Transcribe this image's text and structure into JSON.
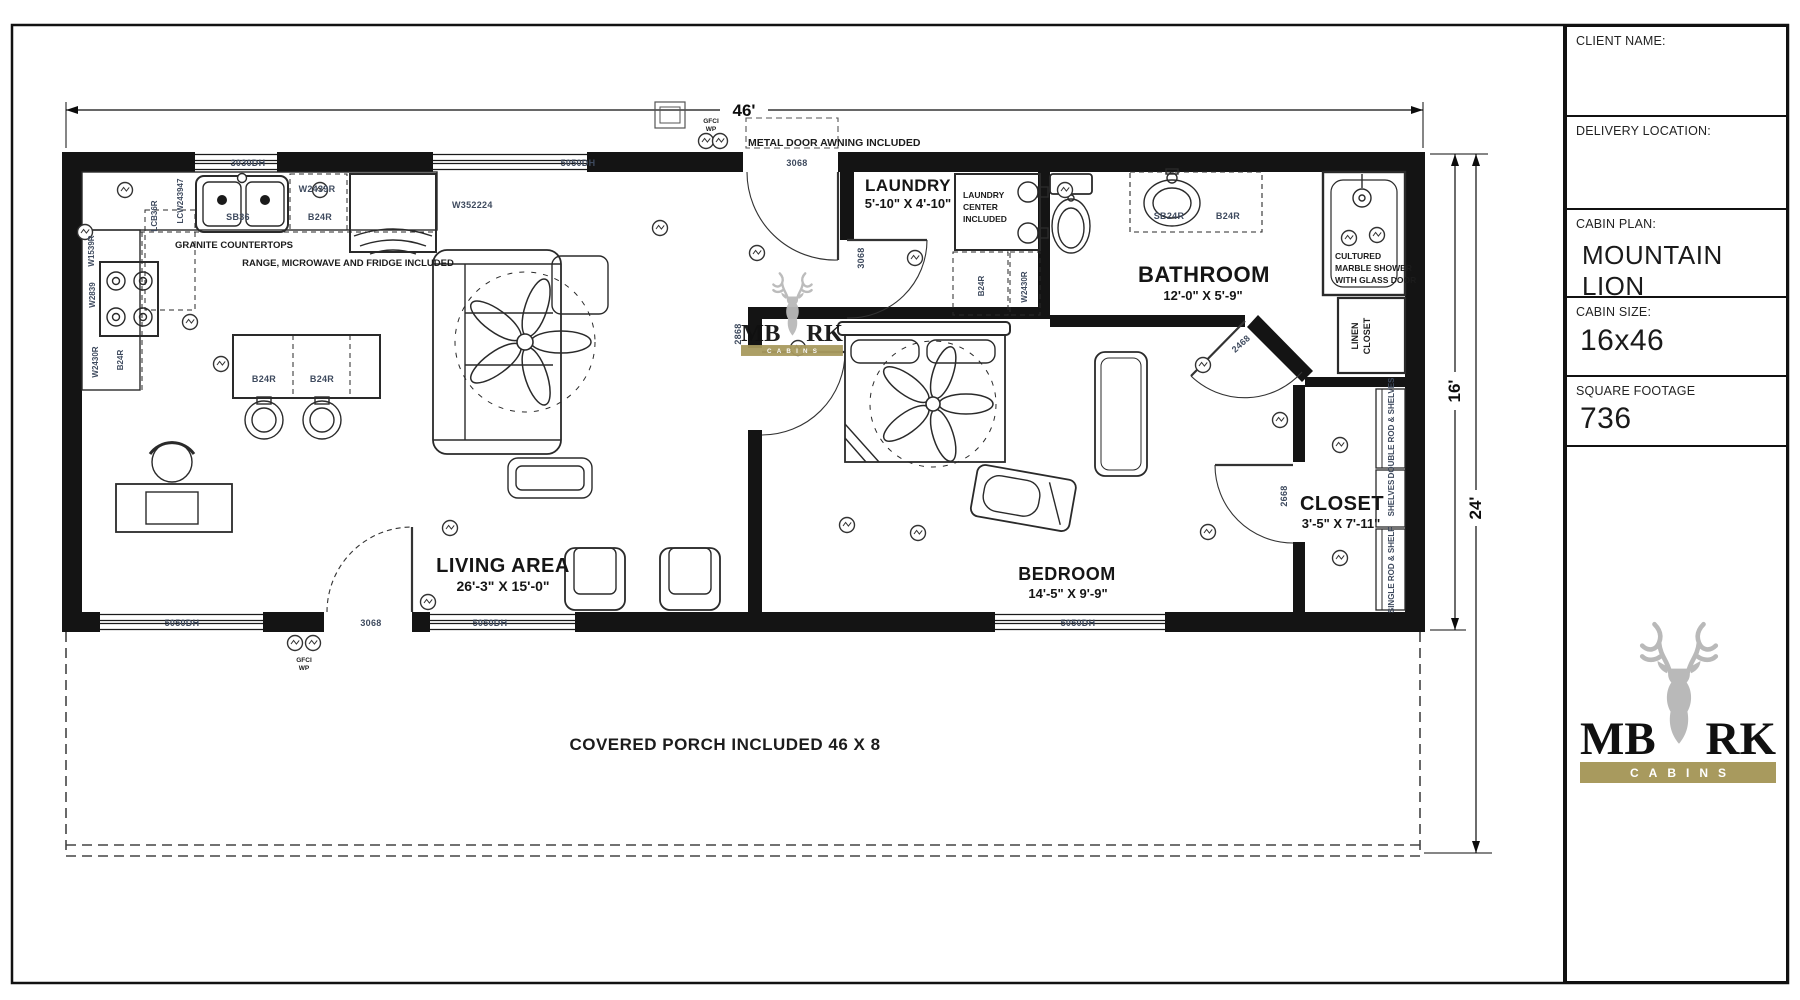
{
  "title_block": {
    "client_name_label": "CLIENT NAME:",
    "delivery_location_label": "DELIVERY LOCATION:",
    "cabin_plan_label": "CABIN PLAN:",
    "cabin_plan_value": "MOUNTAIN LION",
    "cabin_size_label": "CABIN SIZE:",
    "cabin_size_value": "16x46",
    "square_footage_label": "SQUARE FOOTAGE",
    "square_footage_value": "736"
  },
  "brand": {
    "word_left": "MB",
    "word_right": "RK",
    "subtitle": "CABINS",
    "gold": "#a89a5e",
    "deer_gray": "#b9b9b9"
  },
  "dimensions": {
    "overall_width": "46'",
    "cabin_depth": "16'",
    "overall_depth": "24'"
  },
  "rooms": {
    "living": {
      "name": "LIVING AREA",
      "size": "26'-3\" X 15'-0\""
    },
    "bedroom": {
      "name": "BEDROOM",
      "size": "14'-5\" X 9'-9\""
    },
    "bathroom": {
      "name": "BATHROOM",
      "size": "12'-0\" X 5'-9\""
    },
    "laundry": {
      "name": "LAUNDRY",
      "size": "5'-10\" X 4'-10\""
    },
    "closet": {
      "name": "CLOSET",
      "size": "3'-5\" X 7'-11\""
    }
  },
  "notes": {
    "awning": "METAL DOOR AWNING INCLUDED",
    "granite": "GRANITE COUNTERTOPS",
    "appliances": "RANGE, MICROWAVE AND FRIDGE INCLUDED",
    "laundry_center": [
      "LAUNDRY",
      "CENTER",
      "INCLUDED"
    ],
    "shower": [
      "CULTURED",
      "MARBLE SHOWER",
      "WITH GLASS DOOR"
    ],
    "linen": [
      "LINEN",
      "CLOSET"
    ],
    "porch": "COVERED PORCH INCLUDED 46 X 8",
    "gfci": [
      "GFCI",
      "WP"
    ]
  },
  "closet_fittings": {
    "top": "DOUBLE ROD & SHELVES",
    "middle": "SHELVES",
    "bottom": "SINGLE ROD & SHELF"
  },
  "openings": {
    "window_kitchen": "3030DH",
    "window_living_top": "5050DH",
    "front_door": "3068",
    "window_living_bottom_left": "5050DH",
    "porch_door": "3068",
    "window_living_bottom": "5050DH",
    "window_bedroom": "5050DH",
    "laundry_door": "3068",
    "bedroom_door": "2868",
    "bathroom_door": "2468",
    "closet_door": "2668"
  },
  "cabinets": {
    "sink_base": "SB36",
    "kitchen_base": "B24R",
    "kitchen_wall": "W2439R",
    "fridge_wall": "W352224",
    "tall_pantry": "LCW243947",
    "tall_cabinet": "LCB36R",
    "wall_left_top": "W1539R",
    "wall_left_mid": "W2839",
    "wall_left_bottom": "W2430R",
    "base_left": "B24R",
    "island_left": "B24R",
    "island_right": "B24R",
    "laundry_base": "B24R",
    "laundry_wall": "W2430R",
    "vanity_sink_base": "SB24R",
    "vanity_base": "B24R"
  }
}
